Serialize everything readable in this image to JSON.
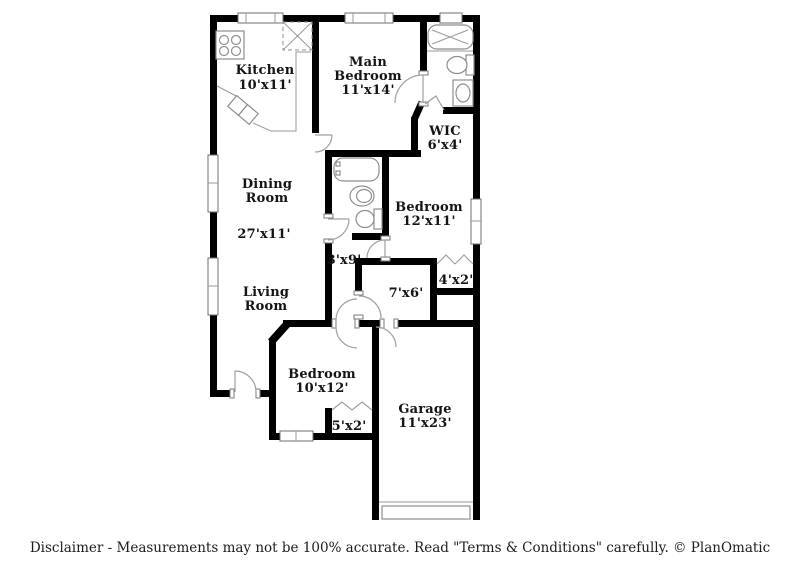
{
  "document": {
    "type": "floor-plan",
    "brand": "PlanOmatic"
  },
  "colors": {
    "background": "#ffffff",
    "wall": "#000000",
    "fixture_line": "#8e8e8e",
    "door_line": "#a0a0a0",
    "label_text": "#141414"
  },
  "rooms": {
    "kitchen": {
      "name": "Kitchen",
      "size": "10'x11'"
    },
    "main_bedroom": {
      "name1": "Main",
      "name2": "Bedroom",
      "size": "11'x14'"
    },
    "wic": {
      "name": "WIC",
      "size": "6'x4'"
    },
    "dining_room": {
      "name1": "Dining",
      "name2": "Room",
      "size": "27'x11'"
    },
    "living_room": {
      "name1": "Living",
      "name2": "Room"
    },
    "bedroom_12x11": {
      "name": "Bedroom",
      "size": "12'x11'"
    },
    "bedroom_10x12": {
      "name": "Bedroom",
      "size": "10'x12'"
    },
    "garage": {
      "name": "Garage",
      "size": "11'x23'"
    },
    "hallway": {
      "size": "3'x9'"
    },
    "utility": {
      "size": "7'x6'"
    },
    "closet_bedroom_12x11": {
      "size": "4'x2'"
    },
    "closet_bedroom_10x12": {
      "size": "5'x2'"
    }
  },
  "footer": {
    "disclaimer": "Disclaimer - Measurements may not be 100% accurate. Read \"Terms & Conditions\" carefully. © PlanOmatic"
  }
}
